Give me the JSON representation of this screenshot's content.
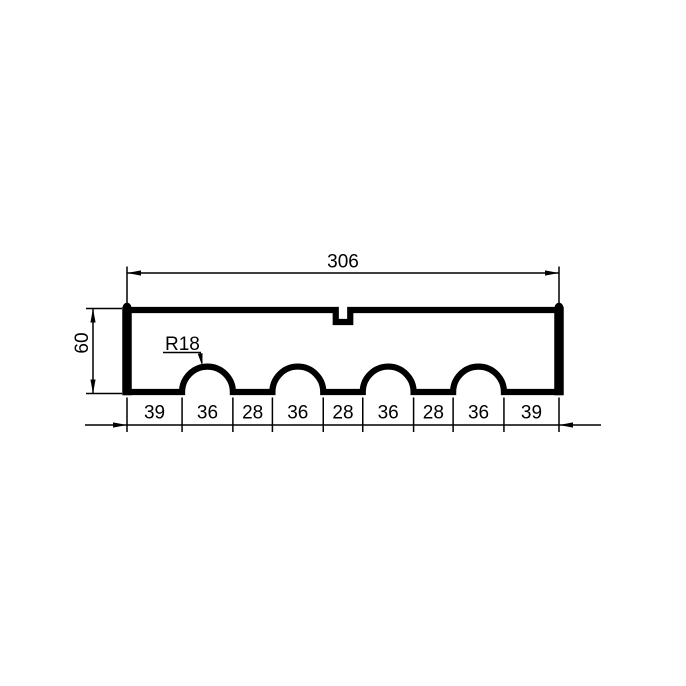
{
  "drawing": {
    "kind": "technical-drawing",
    "description": "Rectangular profile with four semicircular notches on the bottom edge and a small rectangular slot centered on the top edge",
    "labels": {
      "width": "306",
      "height": "60",
      "radius": "R18"
    },
    "overall_width": 306,
    "overall_height": 60,
    "notch_radius": 18,
    "notch_count": 4,
    "segments": [
      39,
      36,
      28,
      36,
      28,
      36,
      28,
      36,
      39
    ],
    "segment_labels": [
      "39",
      "36",
      "28",
      "36",
      "28",
      "36",
      "28",
      "36",
      "39"
    ],
    "colors": {
      "line": "#000000",
      "background": "#ffffff"
    }
  }
}
